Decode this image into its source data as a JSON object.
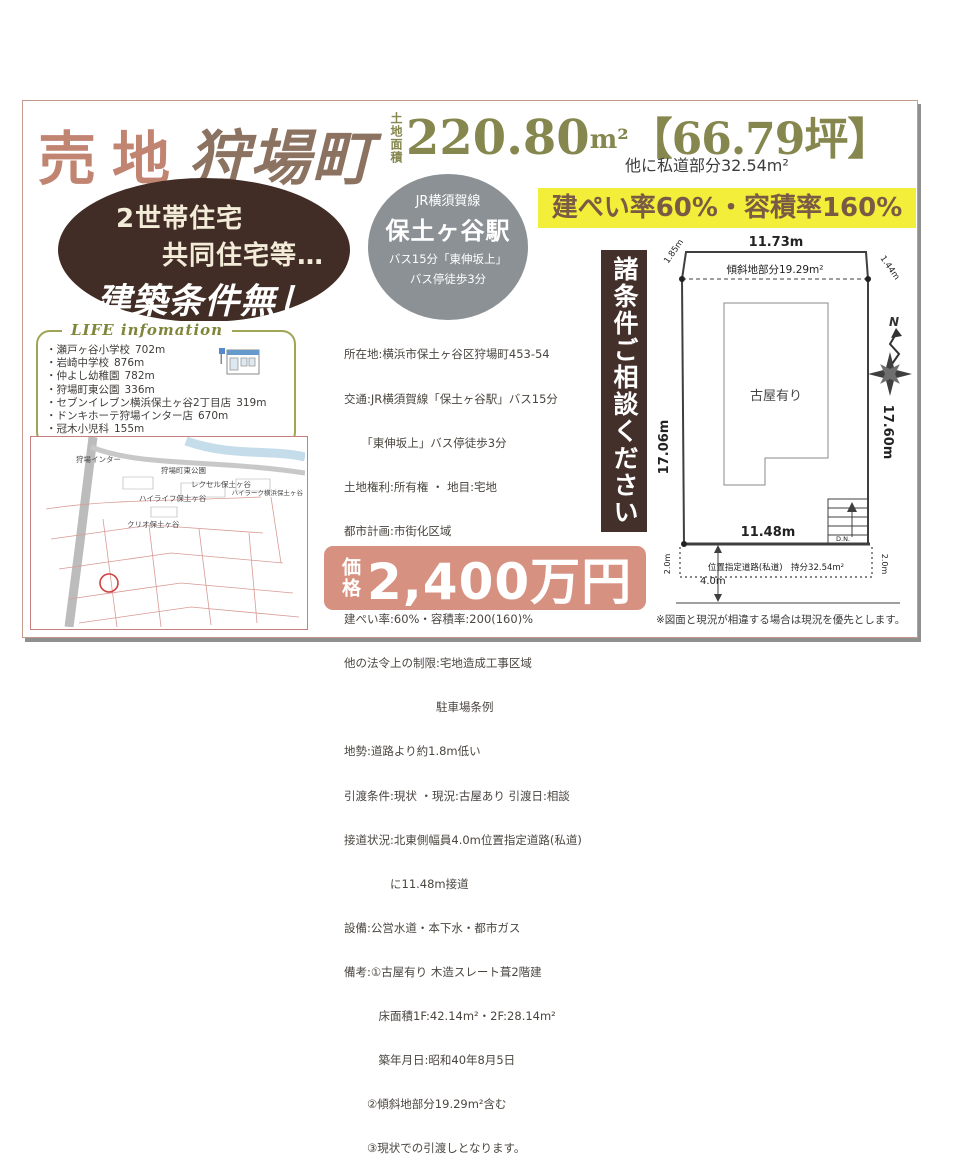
{
  "header": {
    "sale_type": "売地",
    "town": "狩場町",
    "area_label": "土地面積",
    "area_number": "220.80",
    "area_unit": "m²",
    "area_tsubo": "【66.79坪】",
    "area_note": "他に私道部分32.54m²"
  },
  "no_condition_oval": {
    "line1": "2世帯住宅",
    "line2": "共同住宅等…",
    "line3": "建築条件無し"
  },
  "station_circle": {
    "railline": "JR横須賀線",
    "station": "保土ヶ谷駅",
    "bus": "バス15分「東伸坂上」",
    "walk": "バス停徒歩3分"
  },
  "ratio_banner": {
    "text": "建ぺい率60%・容積率160%"
  },
  "life_info": {
    "title": "LIFE infomation",
    "items": [
      {
        "name": "・瀬戸ヶ谷小学校",
        "distance": "702m"
      },
      {
        "name": "・岩崎中学校",
        "distance": "876m"
      },
      {
        "name": "・仲よし幼稚園",
        "distance": "782m"
      },
      {
        "name": "・狩場町東公園",
        "distance": "336m"
      },
      {
        "name": "・セブンイレブン横浜保土ヶ谷2丁目店",
        "distance": "319m"
      },
      {
        "name": "・ドンキホーテ狩場インター店",
        "distance": "670m"
      },
      {
        "name": "・冠木小児科",
        "distance": "155m"
      }
    ]
  },
  "property_details": {
    "lines": [
      "所在地:横浜市保土ヶ谷区狩場町453-54",
      "交通:JR横須賀線「保土ヶ谷駅」バス15分",
      "　　「東伸坂上」バス停徒歩3分",
      "土地権利:所有権 ・ 地目:宅地",
      "都市計画:市街化区域",
      "用途地域:第1種住居地域",
      "建ぺい率:60%・容積率:200(160)%",
      "他の法令上の制限:宅地造成工事区域",
      "　　　　　　　　駐車場条例",
      "地勢:道路より約1.8m低い",
      "引渡条件:現状 ・現況:古屋あり 引渡日:相談",
      "接道状況:北東側幅員4.0m位置指定道路(私道)",
      "　　　　に11.48m接道",
      "設備:公営水道・本下水・都市ガス",
      "備考:①古屋有り 木造スレート葺2階建",
      "　　　床面積1F:42.14m²・2F:28.14m²",
      "　　　築年月日:昭和40年8月5日",
      "　　②傾斜地部分19.29m²含む",
      "　　③現状での引渡しとなります。"
    ]
  },
  "consult_banner": {
    "text": "諸条件ご相談ください"
  },
  "price": {
    "label": "価格",
    "value": "2,400万円"
  },
  "site_plan": {
    "top_width": "11.73m",
    "slant_left": "1.85m",
    "slant_right": "1.44m",
    "slope_label": "傾斜地部分19.29m²",
    "left_side": "17.06m",
    "right_side": "17.60m",
    "building_label": "古屋有り",
    "bottom_width": "11.48m",
    "road_offset_left": "2.0m",
    "road_offset_right": "2.0m",
    "road_label": "位置指定道路(私道)　持分32.54m²",
    "road_width": "4.0m",
    "stairs_label": "D.N.",
    "compass_label": "N"
  },
  "map": {
    "labels": [
      "狩場インター",
      "狩場町東公園",
      "レクセル保土ヶ谷",
      "ハイライフ保土ヶ谷",
      "ハイラーク横浜保土ヶ谷",
      "クリオ保土ヶ谷"
    ]
  },
  "footnote": {
    "text": "※図面と現況が相違する場合は現況を優先とします。"
  }
}
